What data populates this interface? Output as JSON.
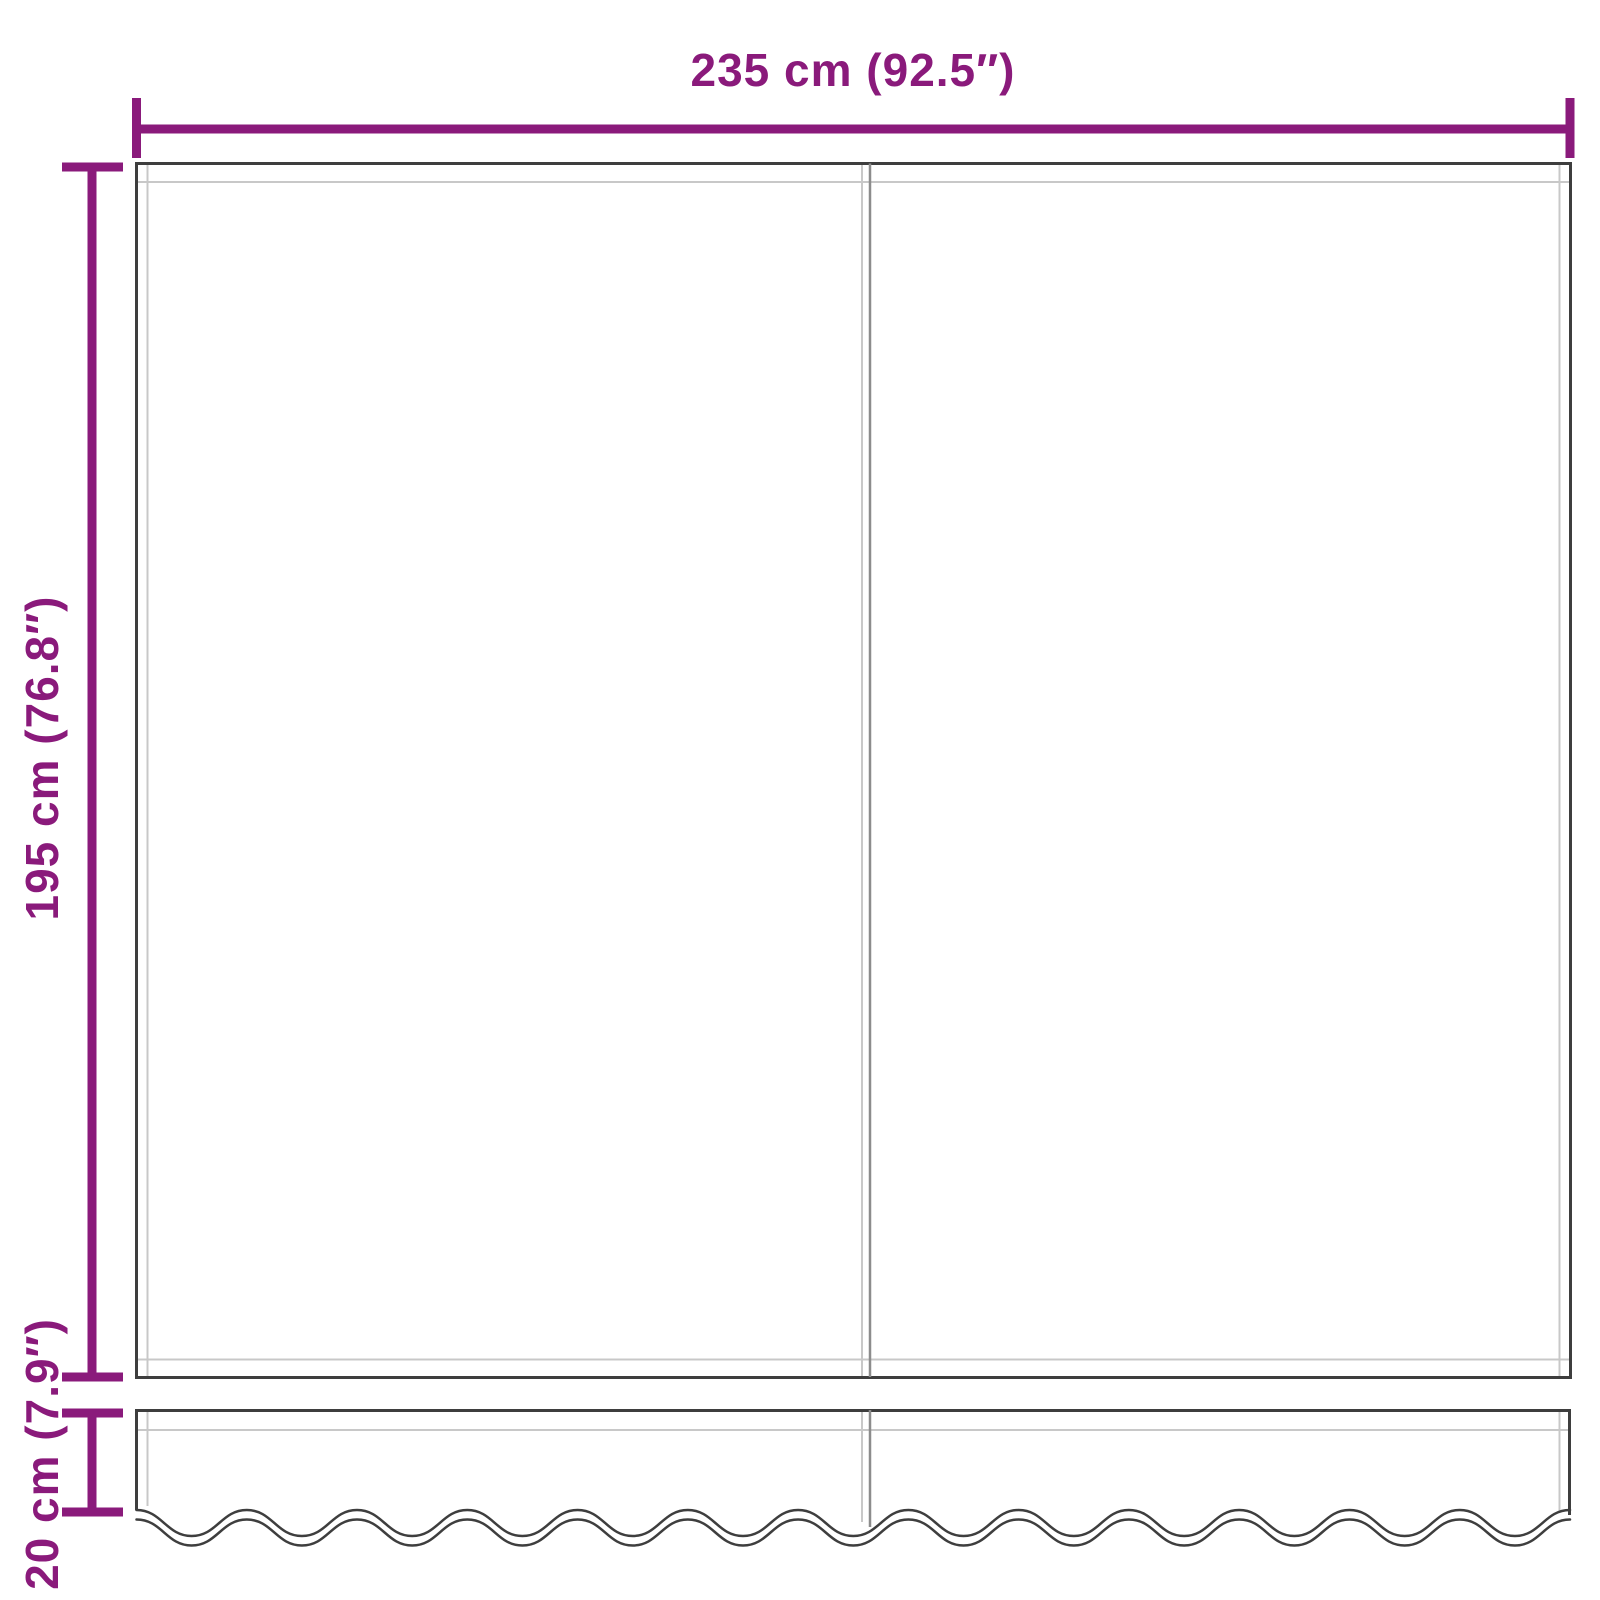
{
  "diagram": {
    "dimensions": {
      "width": {
        "label": "235 cm (92.5″)"
      },
      "height": {
        "label": "195 cm (76.8″)"
      },
      "valance_height": {
        "label": "20 cm (7.9″)"
      }
    },
    "colors": {
      "dimension_accent": "#8A1A7B",
      "outline_dark": "#3E3E3E",
      "outline_light": "#C8C8C8",
      "seam_gray": "#8C8C8C",
      "background": "#FFFFFF"
    }
  }
}
